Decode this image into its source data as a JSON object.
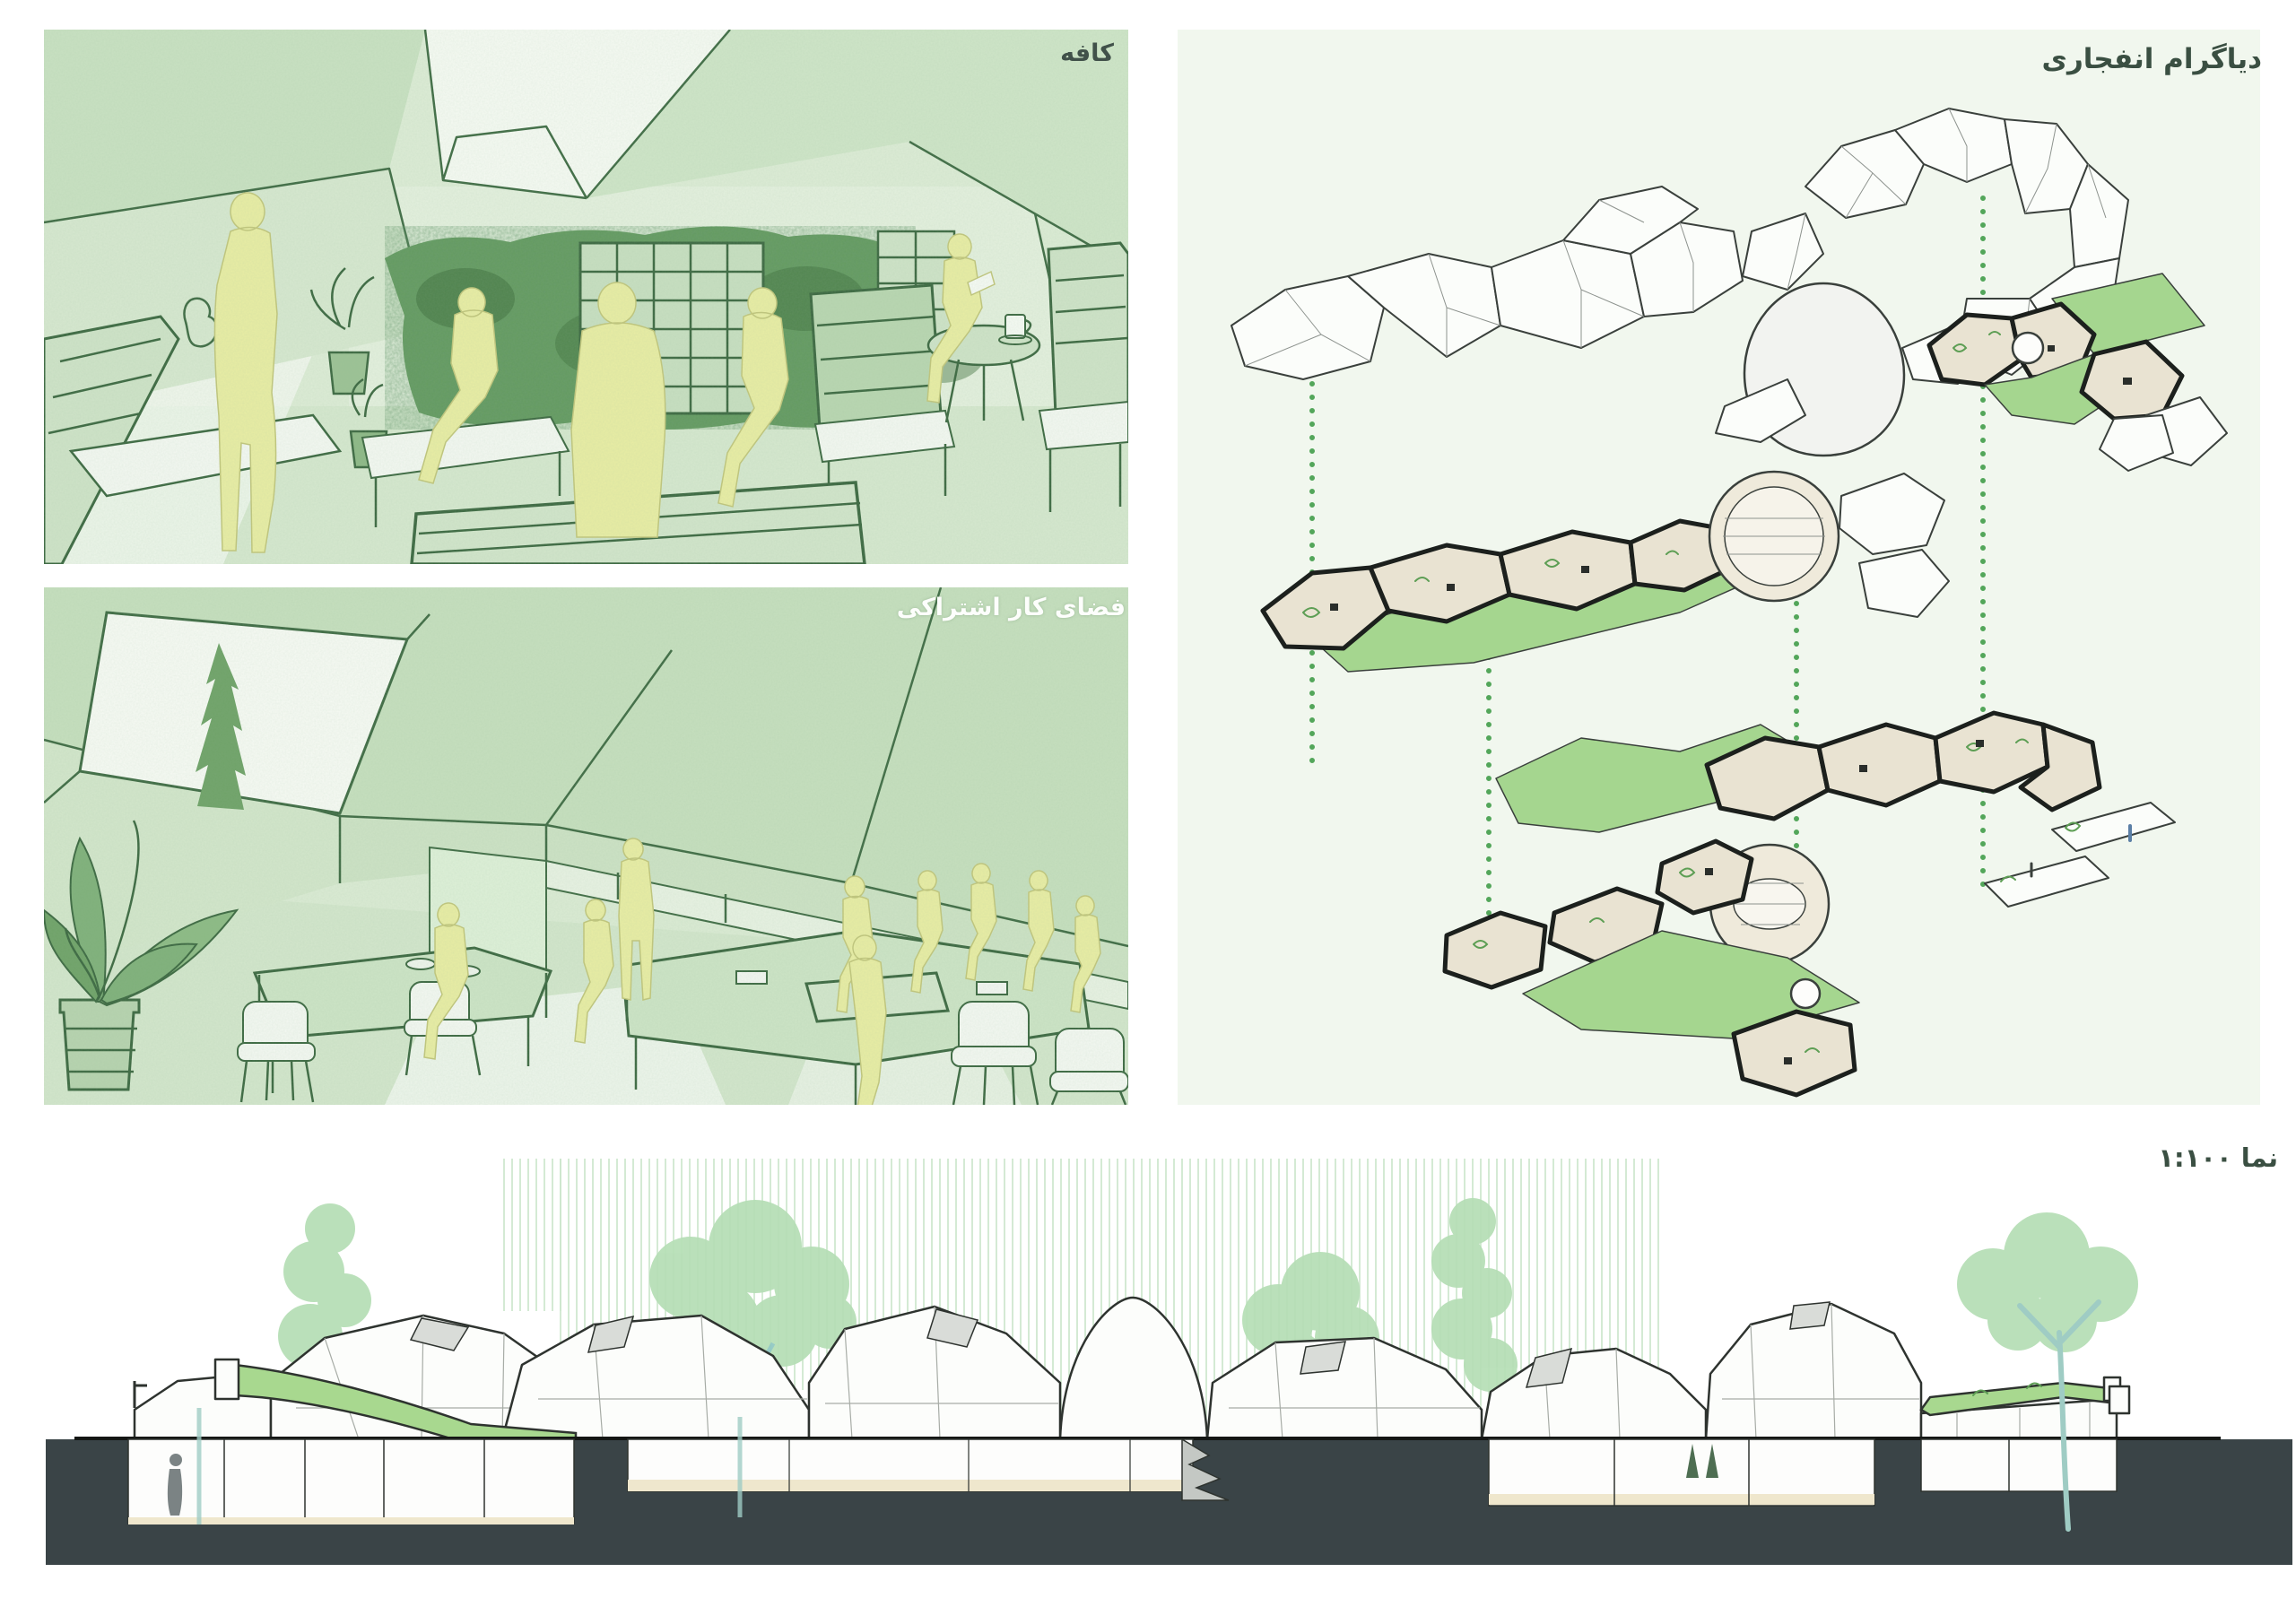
{
  "board": {
    "title": "architecture-presentation-board",
    "panels": {
      "cafe": {
        "label": "کافه"
      },
      "coworking": {
        "label": "فضای کار اشتراکی"
      },
      "exploded_diagram": {
        "label": "دیاگرام انفجاری"
      },
      "elevation": {
        "label": "نما ۱:۱۰۰"
      }
    },
    "colors": {
      "render_base": "#ddecd6",
      "render_line": "#3f6b44",
      "figure_yellow": "#e9eda4",
      "axon_background": "#f1f7ee",
      "plate_green": "#a5d68f",
      "dotted_connector_green": "#53a65a",
      "floor_beige": "#e9e3d2",
      "ground_dark": "#3a4447",
      "tree_soft_green": "#b5deb5",
      "hatch_light_green": "#c9e5c9"
    }
  }
}
